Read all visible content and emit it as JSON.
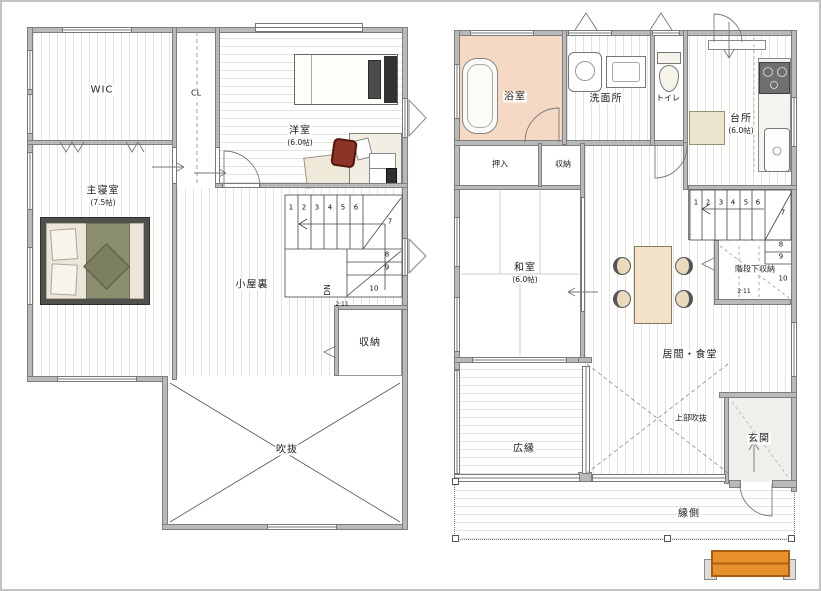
{
  "title": "2-story house floor plan",
  "colors": {
    "wall": "#b9b9b9",
    "bath_pink": "#f6d9c5",
    "table_tan": "#f3e2c8",
    "chair_red": "#8c3426",
    "blanket_olive": "#8b8e70",
    "step_orange": "#e8912c"
  },
  "f2": {
    "wic": "WIC",
    "cl": "CL",
    "yoshitsu": "洋室",
    "yoshitsu_size": "(6.0帖)",
    "shinshitsu": "主寝室",
    "shinshitsu_size": "(7.5帖)",
    "koyaura": "小屋裏",
    "shuno": "収納",
    "fukinuke": "吹抜",
    "dn": "DN",
    "stair_note": "2·11",
    "stairs": [
      "1",
      "2",
      "3",
      "4",
      "5",
      "6",
      "7",
      "8",
      "9",
      "10"
    ]
  },
  "f1": {
    "yokushitsu": "浴室",
    "senmenjo": "洗面所",
    "toire": "トイレ",
    "daidokoro": "台所",
    "daidokoro_size": "(6.0帖)",
    "oshiire": "押入",
    "shuno": "収納",
    "washitsu": "和室",
    "washitsu_size": "(6.0帖)",
    "ima_shokudo": "居間・食堂",
    "kaidanshita_shuno": "階段下収納",
    "genkan": "玄関",
    "hiroen": "広縁",
    "engawa": "縁側",
    "joubu_fukinuke": "上部吹抜",
    "stair_note": "2·11",
    "stairs": [
      "1",
      "2",
      "3",
      "4",
      "5",
      "6",
      "7",
      "8",
      "9",
      "10"
    ]
  }
}
